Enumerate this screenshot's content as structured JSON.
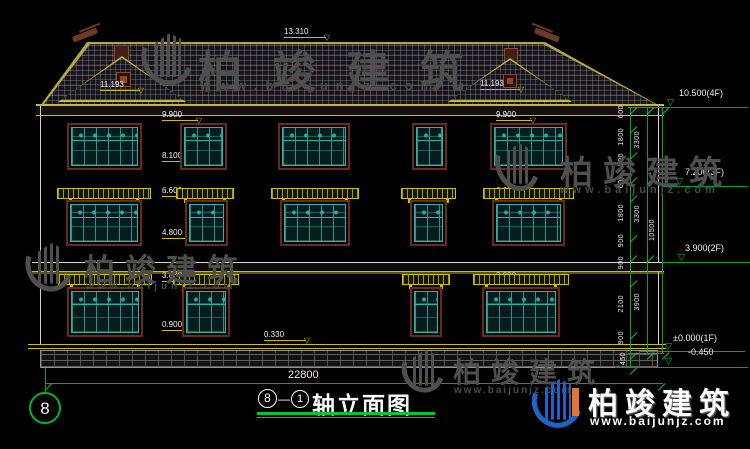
{
  "drawing": {
    "title": {
      "start_axis": "8",
      "dash": "—",
      "end_axis": "1",
      "text": "轴立面图"
    },
    "axis_bubble": "8",
    "overall_width": "22800",
    "elevation_labels": {
      "ridge": "13.310",
      "gable": "11.193",
      "eave": "9.900",
      "f3_sill": "8.100",
      "f3_floor": "6.600",
      "f2_sill": "4.800",
      "f1_awning": "3.000",
      "f1_sill": "0.900",
      "plinth": "0.330"
    },
    "levels": {
      "f4": "10.500(4F)",
      "f3": "7.200(3F)",
      "f2": "3.900(2F)",
      "f1": "±0.000(1F)",
      "ground": "-0.450"
    },
    "dims": {
      "col1": [
        "600",
        "1800",
        "900",
        "600",
        "1800",
        "900",
        "900",
        "2100",
        "900"
      ],
      "base": "450",
      "col2": [
        "3300",
        "3300",
        "3900"
      ],
      "col3": "10500"
    }
  },
  "watermark": {
    "cn": "柏竣建筑",
    "url": "www.baijunjz.com"
  },
  "logo": {
    "cn": "柏竣建筑",
    "url": "www.baijunjz.com"
  },
  "colors": {
    "background": "#000000",
    "dimension_green": "#00b42e",
    "accent_yellow": "#cdbe00",
    "window_teal": "#2eb2aa",
    "frame_maroon": "#6e2a18",
    "logo_blue": "#1e64c8",
    "logo_orange": "#e8762a"
  }
}
